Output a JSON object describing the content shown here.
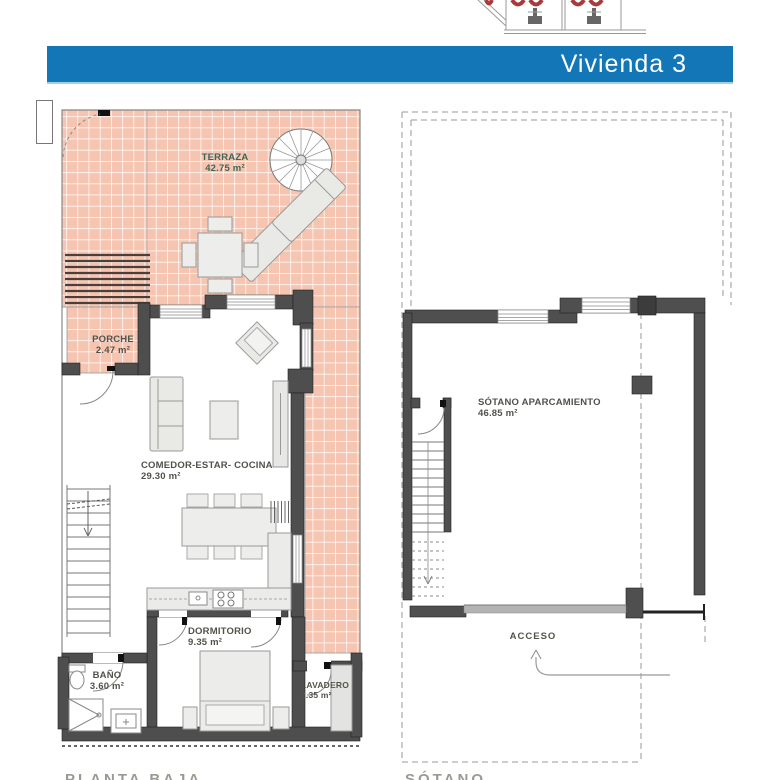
{
  "header": {
    "title": "Vivienda 3"
  },
  "floor_plan": {
    "caption": "PLANTA BAJA",
    "rooms": [
      {
        "name": "TERRAZA",
        "area": "42.75 m²"
      },
      {
        "name": "PORCHE",
        "area": "2.47 m²"
      },
      {
        "name": "COMEDOR-ESTAR- COCINA",
        "area": "29.30 m²"
      },
      {
        "name": "DORMITORIO",
        "area": "9.35 m²"
      },
      {
        "name": "BAÑO",
        "area": "3.60 m²"
      },
      {
        "name": "LAVADERO",
        "area": "2.35 m²"
      }
    ]
  },
  "basement_plan": {
    "caption": "SÓTANO",
    "room": {
      "name": "SÓTANO APARCAMIENTO",
      "area": "46.85 m²"
    },
    "access_label": "ACCESO"
  },
  "colors": {
    "header_bar": "#1377b7",
    "header_underline": "#9ed3da",
    "tile_fill": "#f6c5b1",
    "tile_grout": "#ffffff",
    "wall": "#4e4e4e",
    "terrace_label_text": "#3f6457",
    "room_label_text": "#52524b",
    "key_plan_mark_red": "#a93a3c"
  }
}
